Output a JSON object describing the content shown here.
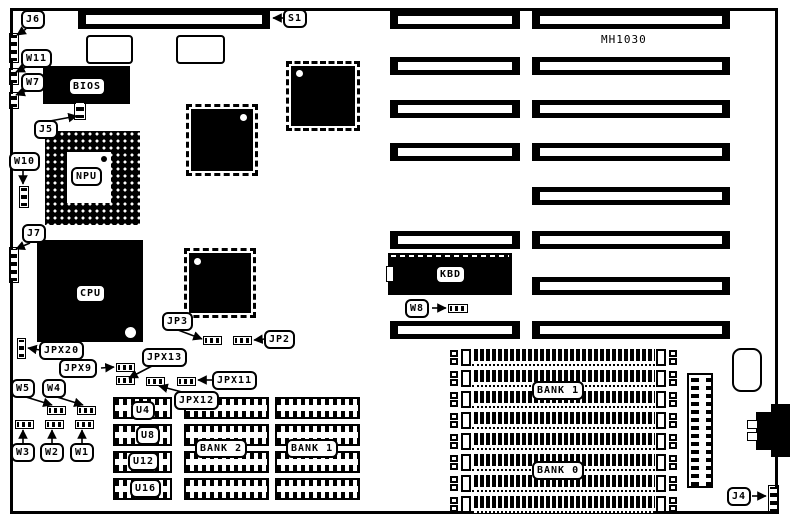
{
  "board_title": "MH1030",
  "colors": {
    "ink": "#000000",
    "background": "#ffffff"
  },
  "chips": {
    "bios": "BIOS",
    "npu": "NPU",
    "cpu": "CPU",
    "kbd": "KBD"
  },
  "memory_labels": {
    "bank2_dip": "BANK 2",
    "bank1_dip": "BANK 1",
    "bank1_simm": "BANK 1",
    "bank0_simm": "BANK 0",
    "u4": "U4",
    "u8": "U8",
    "u12": "U12",
    "u16": "U16"
  },
  "connectors": {
    "s1": "S1",
    "j6": "J6",
    "j5": "J5",
    "j7": "J7",
    "j4": "J4"
  },
  "jumpers": {
    "w11": "W11",
    "w10": "W10",
    "w8": "W8",
    "w7": "W7",
    "w5": "W5",
    "w4": "W4",
    "w3": "W3",
    "w2": "W2",
    "w1": "W1",
    "jp3": "JP3",
    "jp2": "JP2",
    "jpx20": "JPX20",
    "jpx13": "JPX13",
    "jpx12": "JPX12",
    "jpx11": "JPX11",
    "jpx9": "JPX9"
  }
}
